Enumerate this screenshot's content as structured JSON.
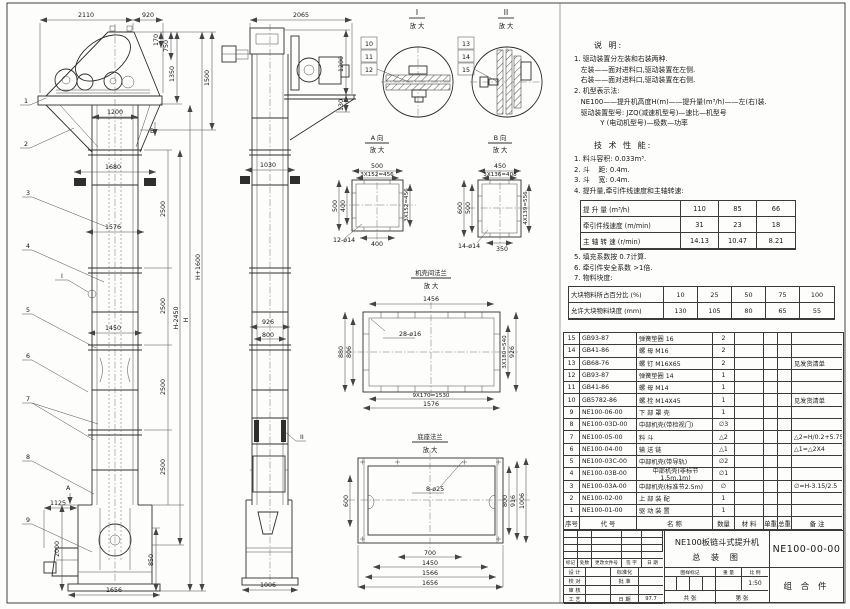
{
  "front_view": {
    "balloons": [
      "1",
      "2",
      "3",
      "4",
      "5",
      "6",
      "7",
      "8",
      "9"
    ],
    "dim_2110": "2110",
    "dim_920": "920",
    "dim_170": "170",
    "dim_750": "750",
    "dim_1350": "1350",
    "dim_1500": "1500",
    "dim_1200": "1200",
    "dim_1680": "1680",
    "dim_1576": "1576",
    "dim_1450": "1450",
    "dim_2500": "2500",
    "dim_H": "H",
    "dim_Hm": "H-2450",
    "dim_Hp": "H+1600",
    "dim_1125": "1125",
    "dim_2000": "2000",
    "dim_850": "850",
    "dim_1656": "1656",
    "label_A": "A",
    "label_B": "B",
    "label_I": "I"
  },
  "side_view": {
    "dim_2065": "2065",
    "dim_1200": "1200",
    "dim_130": "130",
    "dim_1030": "1030",
    "dim_926": "926",
    "dim_800": "800",
    "dim_1006": "1006",
    "label_II": "II"
  },
  "detail_i": {
    "title": "I",
    "sub": "放 大",
    "balloons": [
      "10",
      "11",
      "12"
    ]
  },
  "detail_ii": {
    "title": "II",
    "sub": "放 大",
    "balloons": [
      "13",
      "14",
      "15"
    ]
  },
  "view_a": {
    "title": "A 向",
    "sub": "放 大",
    "d_top": "500",
    "d_top2": "3X152=456",
    "d_left": "500",
    "d_left2": "400",
    "d_right": "3X152=456",
    "d_bot": "400",
    "holes": "12-ø14"
  },
  "view_b": {
    "title": "B 向",
    "sub": "放 大",
    "d_top": "450",
    "d_top2": "3X136=408",
    "d_left": "600",
    "d_left2": "500",
    "d_right": "4X139=556",
    "d_bot": "350",
    "holes": "14-ø14"
  },
  "flange_view": {
    "title": "机壳间法兰",
    "sub": "放 大",
    "d_top": "1456",
    "d_left": "880",
    "d_left2": "806",
    "d_right": "3X180=540",
    "d_right2": "926",
    "d_bot": "9X170=1530",
    "d_bot2": "1576",
    "holes": "28-ø16"
  },
  "base_view": {
    "title": "底座法兰",
    "sub": "放 大",
    "d_left": "600",
    "d_r1": "800",
    "d_r2": "916",
    "d_r3": "1006",
    "d_b1": "700",
    "d_b2": "1450",
    "d_b3": "1566",
    "d_b4": "1656",
    "holes": "8-ø25"
  },
  "notes": {
    "title": "说 明:",
    "lines": [
      "1. 驱动装置分左装和右装两种.",
      "   左装——面对进料口,驱动装置在左侧.",
      "   右装——面对进料口,驱动装置在右侧.",
      "2. 机型表示法:",
      "   NE100——提升机高度H(m)——提升量(m³/h)——左(右)装.",
      "   驱动装置型号: JZQ(减速机型号)—速比—机型号",
      "            Y (电动机型号)—极数—功率"
    ]
  },
  "tech": {
    "title": "技 术 性 能:",
    "items_a": [
      "1. 料斗容积: 0.033m³.",
      "2. 斗    距: 0.4m.",
      "3. 斗    宽: 0.4m.",
      "4. 提升量,牵引件线速度和主轴转速:"
    ],
    "table1_rows": [
      {
        "label": "提 升 量 (m³/h)",
        "v1": "110",
        "v2": "85",
        "v3": "66"
      },
      {
        "label": "牵引件线速度 (m/min)",
        "v1": "31",
        "v2": "23",
        "v3": "18"
      },
      {
        "label": "主 轴 转 速 (r/min)",
        "v1": "14.13",
        "v2": "10.47",
        "v3": "8.21"
      }
    ],
    "items_b": [
      "5. 填充系数按 0.7计算.",
      "6. 牵引件安全系数 >1倍.",
      "7. 物料块度:"
    ],
    "table2_rows": [
      {
        "c0": "大块物料所占百分比 (%)",
        "c1": "10",
        "c2": "25",
        "c3": "50",
        "c4": "75",
        "c5": "100"
      },
      {
        "c0": "允许大块物料块度 (mm)",
        "c1": "130",
        "c2": "105",
        "c3": "80",
        "c4": "65",
        "c5": "55"
      }
    ]
  },
  "parts": {
    "header": [
      "序号",
      "代  号",
      "名  称",
      "数量",
      "材  料",
      "单重",
      "总重",
      "备  注"
    ],
    "rows": [
      [
        "15",
        "GB93-87",
        "弹簧垫圈 16",
        "2",
        "",
        "",
        "",
        ""
      ],
      [
        "14",
        "GB41-86",
        "螺 母  M16",
        "2",
        "",
        "",
        "",
        ""
      ],
      [
        "13",
        "GB68-76",
        "螺 钉  M16X65",
        "2",
        "",
        "",
        "",
        "见发货清单"
      ],
      [
        "12",
        "GB93-87",
        "弹簧垫圈 14",
        "1",
        "",
        "",
        "",
        ""
      ],
      [
        "11",
        "GB41-86",
        "螺 母  M14",
        "1",
        "",
        "",
        "",
        ""
      ],
      [
        "10",
        "GB5782-86",
        "螺 栓  M14X45",
        "1",
        "",
        "",
        "",
        "见发货清单"
      ],
      [
        "9",
        "NE100-06-00",
        "下 部 罩 壳",
        "1",
        "",
        "",
        "",
        ""
      ],
      [
        "8",
        "NE100-03D-00",
        "中部机壳(带检视门)",
        "∅3",
        "",
        "",
        "",
        ""
      ],
      [
        "7",
        "NE100-05-00",
        "料  斗",
        "△2",
        "",
        "",
        "",
        "△2=H/0.2+5.75"
      ],
      [
        "6",
        "NE100-04-00",
        "输 送 链",
        "△1",
        "",
        "",
        "",
        "△1=△2X4"
      ],
      [
        "5",
        "NE100-03C-00",
        "中部机壳(带导轨)",
        "∅2",
        "",
        "",
        "",
        ""
      ],
      [
        "4",
        "NE100-03B-00",
        "中部机壳(非标节1.5m,1m)",
        "∅1",
        "",
        "",
        "",
        ""
      ],
      [
        "3",
        "NE100-03A-00",
        "中部机壳(标准节2.5m)",
        "∅",
        "",
        "",
        "",
        "∅=H-3.15/2.5"
      ],
      [
        "2",
        "NE100-02-00",
        "上 部 装 配",
        "1",
        "",
        "",
        "",
        ""
      ],
      [
        "1",
        "NE100-01-00",
        "驱 动 装 置",
        "1",
        "",
        "",
        "",
        ""
      ]
    ]
  },
  "title_block": {
    "rev_header": [
      "标记",
      "处数",
      "更改文件号",
      "签 字",
      "日 期"
    ],
    "sign_rows": [
      [
        "设 计",
        "",
        "标准化",
        ""
      ],
      [
        "校 对",
        "",
        "批 准",
        ""
      ],
      [
        "审 核",
        "",
        "",
        ""
      ],
      [
        "工 艺",
        "",
        "日 期",
        "97.7"
      ]
    ],
    "title1": "NE100板链斗式提升机",
    "title2": "总  装  图",
    "stamp": [
      "图样标记",
      "重 量",
      "比 例"
    ],
    "scale": "1:50",
    "sheet1": "共  张",
    "sheet2": "第  张",
    "dwg_no": "NE100-00-00",
    "part_kind": "组 合 件"
  }
}
